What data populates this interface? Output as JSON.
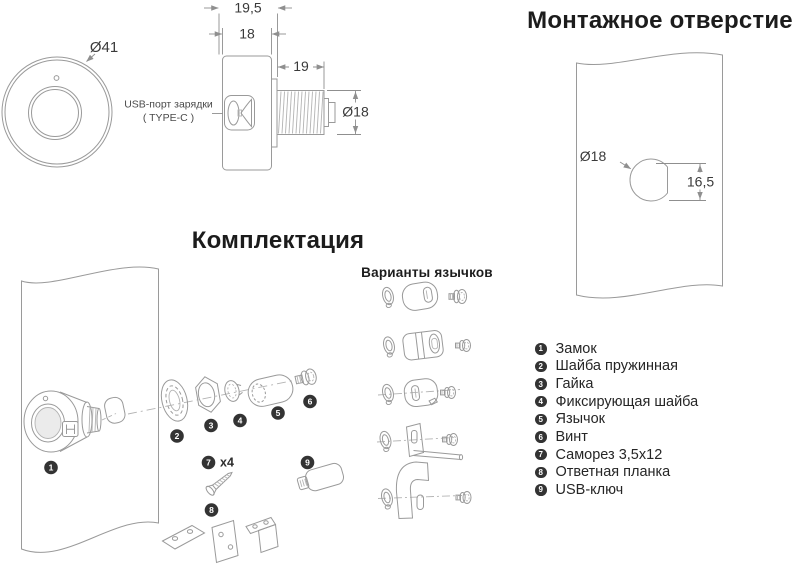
{
  "front_view": {
    "diameter": "Ø41"
  },
  "side_view": {
    "dim_total": "19,5",
    "dim_body": "18",
    "dim_thread_len": "19",
    "dim_thread_dia": "Ø18",
    "usb_line1": "USB-порт зарядки",
    "usb_line2": "( TYPE-C )"
  },
  "mounting_hole": {
    "title": "Монтажное отверстие",
    "dia": "Ø18",
    "offset": "16,5"
  },
  "kit": {
    "title": "Комплектация",
    "screw_qty": "x4"
  },
  "variants": {
    "title": "Варианты язычков"
  },
  "parts_list": {
    "items": [
      {
        "num": "1",
        "label": "Замок"
      },
      {
        "num": "2",
        "label": "Шайба пружинная"
      },
      {
        "num": "3",
        "label": "Гайка"
      },
      {
        "num": "4",
        "label": "Фиксирующая шайба"
      },
      {
        "num": "5",
        "label": "Язычок"
      },
      {
        "num": "6",
        "label": "Винт"
      },
      {
        "num": "7",
        "label": "Саморез 3,5х12"
      },
      {
        "num": "8",
        "label": "Ответная планка"
      },
      {
        "num": "9",
        "label": "USB-ключ"
      }
    ]
  }
}
